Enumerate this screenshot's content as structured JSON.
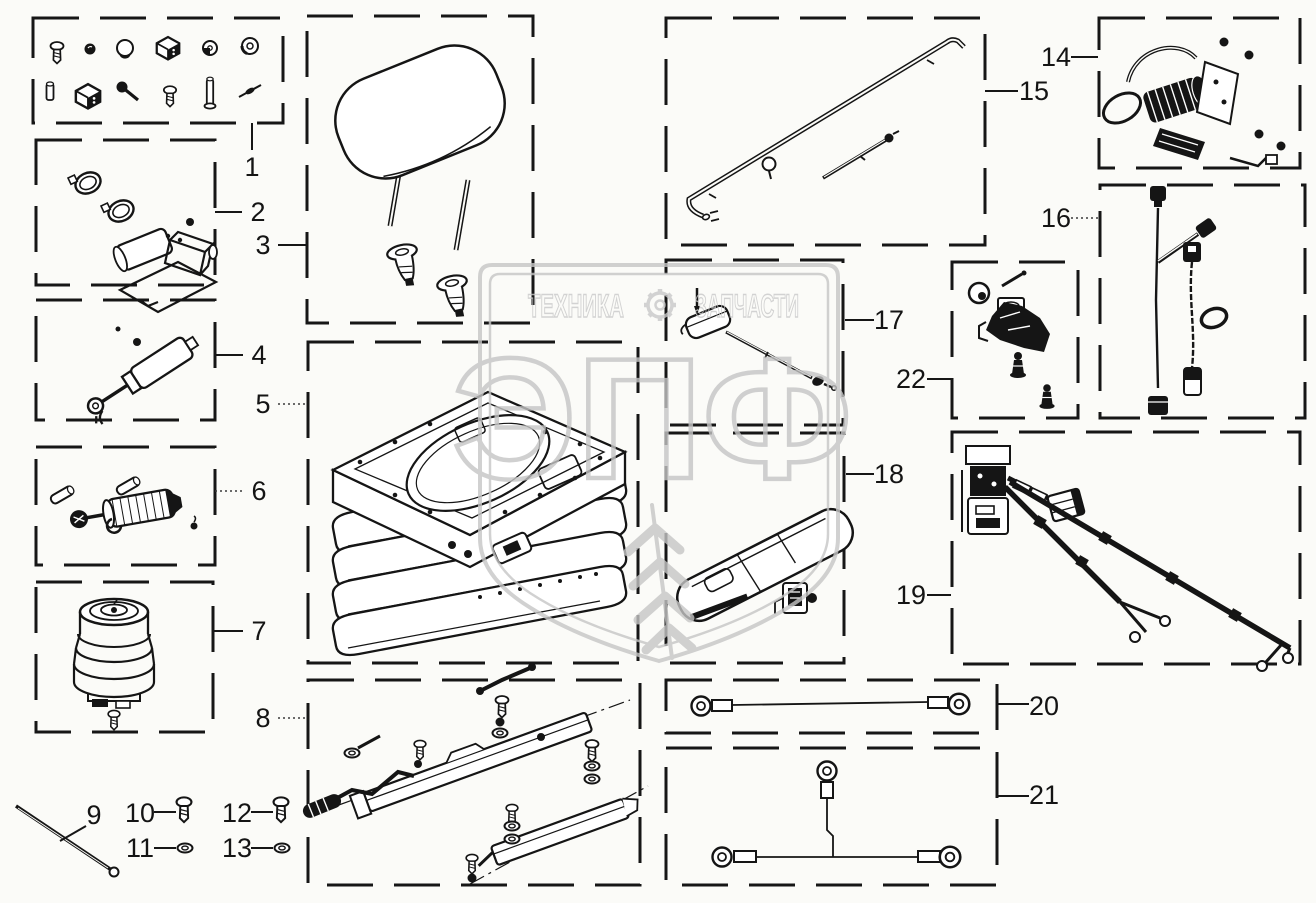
{
  "colors": {
    "background": "#fbfbf8",
    "line_art": "#151515",
    "watermark": "#c6c6c6"
  },
  "watermark": {
    "brand_left": "ТЕХНИКА",
    "brand_right": "ЗАПЧАСТИ",
    "logo_letters": "ЭПФ"
  },
  "callouts": {
    "c1": "1",
    "c2": "2",
    "c3": "3",
    "c4": "4",
    "c5": "5",
    "c6": "6",
    "c7": "7",
    "c8": "8",
    "c9": "9",
    "c10": "10",
    "c11": "11",
    "c12": "12",
    "c13": "13",
    "c14": "14",
    "c15": "15",
    "c16": "16",
    "c17": "17",
    "c18": "18",
    "c19": "19",
    "c20": "20",
    "c21": "21",
    "c22": "22"
  }
}
